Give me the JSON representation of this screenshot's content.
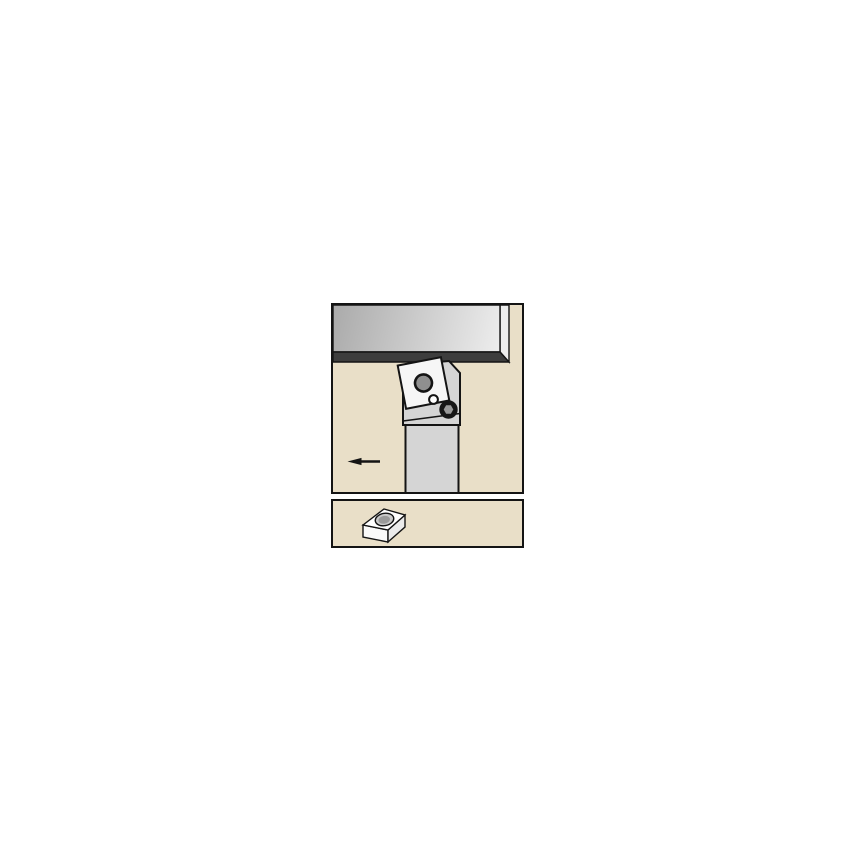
{
  "figure": {
    "kind": "technical-line-illustration",
    "main_view": {
      "name": "turning-operation-side-view",
      "elements": [
        "workpiece",
        "tool-holder-head",
        "tool-holder-shank",
        "square-insert",
        "insert-hole",
        "clamp-pin",
        "clamp-screw",
        "feed-direction-arrow-left"
      ]
    },
    "insert_view": {
      "name": "square-insert-3d-view",
      "elements": [
        "insert-top-face",
        "insert-front-face",
        "insert-side-face",
        "insert-center-hole"
      ]
    }
  },
  "colors": {
    "page_background": "#ffffff",
    "panel_fill": "#e9dfc8",
    "panel_border": "#141414",
    "workpiece_shade_dark": "#aaaaaa",
    "workpiece_shade_light": "#f0f0f0",
    "workpiece_rim": "#ededed",
    "workpiece_edge": "#3d3d3d",
    "tool_body": "#d5d5d5",
    "insert_face": "#f6f6f6",
    "insert_hole": "#8f8f8f",
    "pin_face": "#ffffff",
    "screw_head": "#161616",
    "screw_socket": "#9a9a9a",
    "arrow": "#141414",
    "insert3d_top": "#ffffff",
    "insert3d_front": "#fafafa",
    "insert3d_side": "#ebebeb",
    "insert3d_hole_outer": "#c9c9c9",
    "insert3d_hole_inner": "#9a9a9a"
  }
}
